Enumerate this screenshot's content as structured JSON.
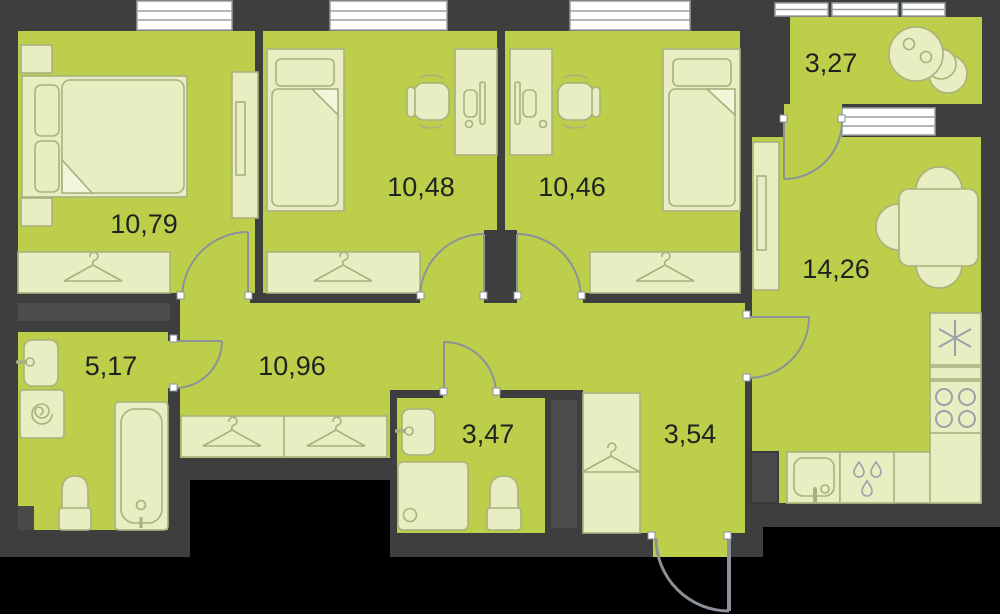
{
  "plan": {
    "type": "apartment-floor-plan",
    "rooms": [
      {
        "name": "bedroom-1",
        "area": "10,79"
      },
      {
        "name": "bedroom-2",
        "area": "10,48"
      },
      {
        "name": "bedroom-3",
        "area": "10,46"
      },
      {
        "name": "balcony",
        "area": "3,27"
      },
      {
        "name": "kitchen-living-room",
        "area": "14,26"
      },
      {
        "name": "hallway",
        "area": "10,96"
      },
      {
        "name": "bathroom",
        "area": "5,17"
      },
      {
        "name": "toilet",
        "area": "3,47"
      },
      {
        "name": "entry-hall",
        "area": "3,54"
      }
    ],
    "colors": {
      "background": "#000000",
      "wall": "#3d3f3e",
      "wall_light": "#4b4d4c",
      "floor": "#bdcf4a",
      "furniture_fill": "#e9edc2",
      "furniture_stroke": "#a8b17e",
      "fixture_stroke": "#99a2a9",
      "door_stroke": "#8b9299",
      "window_fill": "#ffffff",
      "window_stroke": "#9aa0a4",
      "label_color": "#1f2320"
    }
  }
}
